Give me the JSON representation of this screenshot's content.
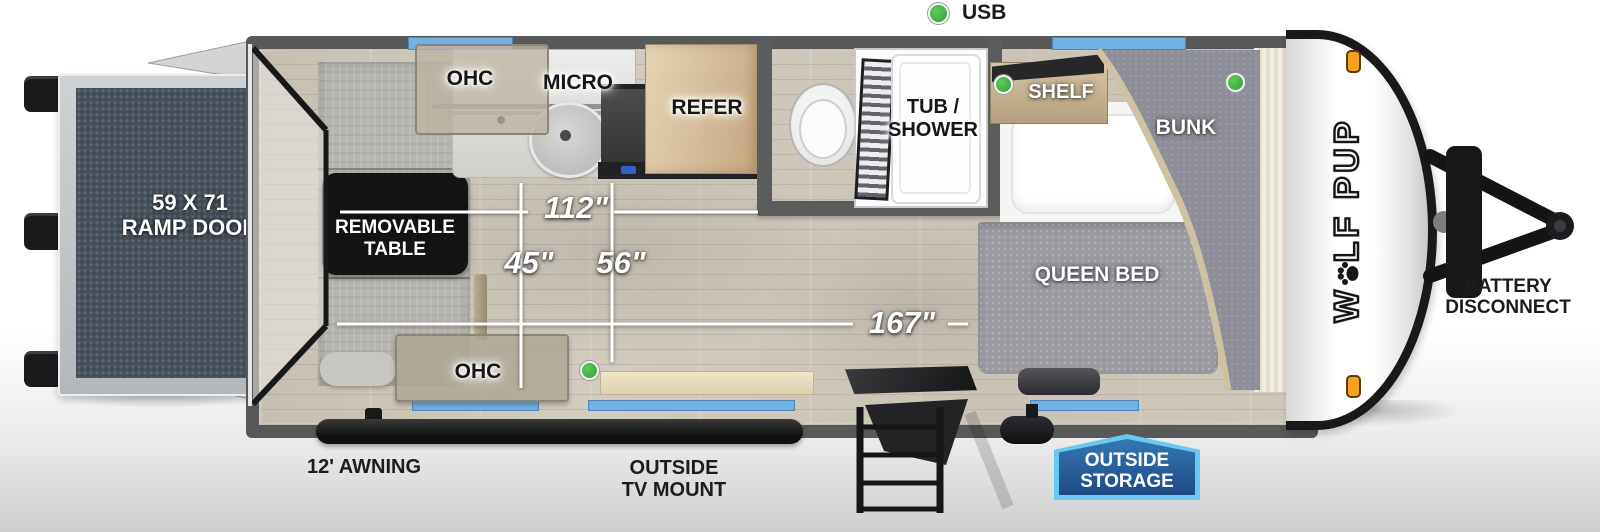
{
  "legend": {
    "usb": "USB"
  },
  "plan": {
    "ramp_size": "59 X 71",
    "ramp_label": "RAMP DOOR",
    "table_line1": "REMOVABLE",
    "table_line2": "TABLE",
    "ohc_front": "OHC",
    "micro": "MICRO",
    "refer": "REFER",
    "tub_line1": "TUB /",
    "tub_line2": "SHOWER",
    "shelf": "SHELF",
    "bunk": "BUNK",
    "queen_bed": "QUEEN BED",
    "ohc_rear": "OHC"
  },
  "dims": {
    "d112": "112\"",
    "d45": "45\"",
    "d56": "56\"",
    "d167": "167\""
  },
  "exterior": {
    "awning": "12' AWNING",
    "tv_line1": "OUTSIDE",
    "tv_line2": "TV MOUNT",
    "storage_line1": "OUTSIDE",
    "storage_line2": "STORAGE",
    "battery_line1": "BATTERY",
    "battery_line2": "DISCONNECT",
    "brand_w": "W",
    "brand_rest": "LF PUP"
  },
  "colors": {
    "window_blue": "#71b2e2",
    "usb_green": "#3fae47",
    "badge_blue_dark": "#1f4c86",
    "badge_blue_light": "#62c7ef",
    "marker_orange": "#f6a21c",
    "ramp_slate": "#4a5561"
  }
}
